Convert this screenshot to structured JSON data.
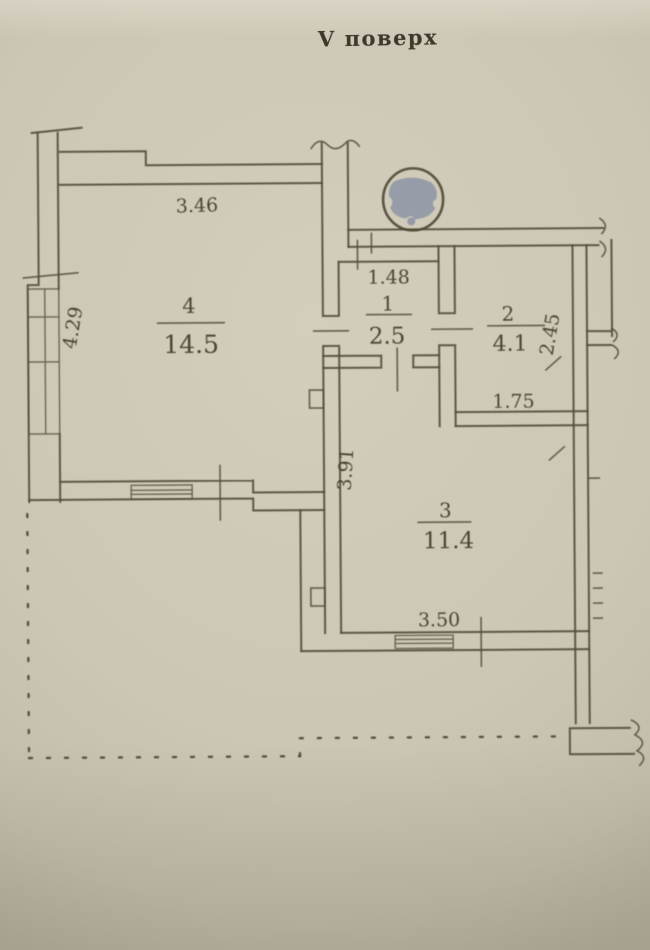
{
  "title": "V поверх",
  "plan": {
    "rooms": [
      {
        "number": "1",
        "area": "2.5"
      },
      {
        "number": "2",
        "area": "4.1"
      },
      {
        "number": "3",
        "area": "11.4"
      },
      {
        "number": "4",
        "area": "14.5"
      }
    ],
    "dimensions": [
      {
        "label": "3.46",
        "of": "room-4-top-width"
      },
      {
        "label": "4.29",
        "of": "room-4-left-height"
      },
      {
        "label": "1.48",
        "of": "room-1-width"
      },
      {
        "label": "2.45",
        "of": "room-2-right-height"
      },
      {
        "label": "1.75",
        "of": "room-2-bottom-width"
      },
      {
        "label": "3.91",
        "of": "room-3-left-height"
      },
      {
        "label": "3.50",
        "of": "room-3-bottom-width"
      }
    ],
    "annotations": [
      {
        "type": "redaction-circle",
        "description": "gray filled circle over drawing"
      }
    ]
  },
  "colors": {
    "paper": "#ccc6b4",
    "ink": "#544d3c",
    "redaction_fill": "#949aa7"
  }
}
